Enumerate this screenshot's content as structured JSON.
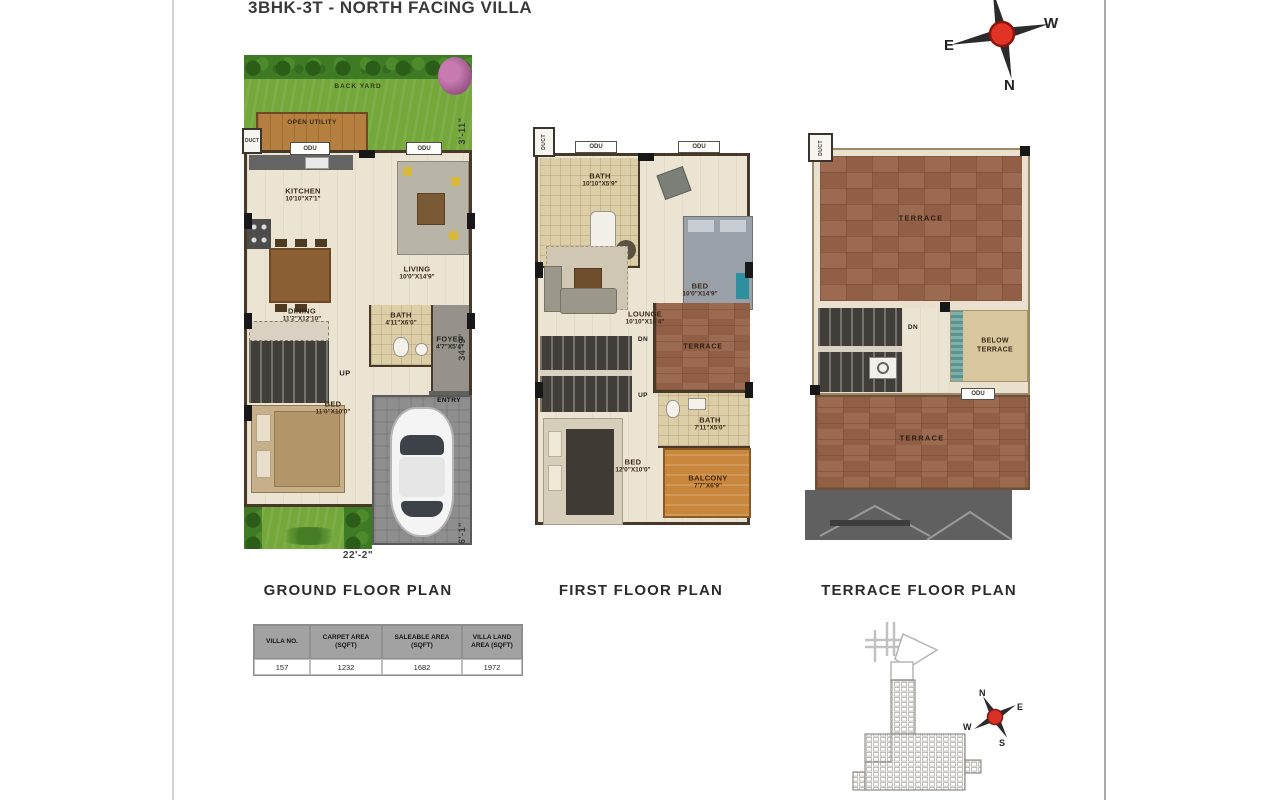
{
  "title": "3BHK-3T - NORTH FACING VILLA",
  "compass": {
    "e": "E",
    "w": "W",
    "n": "N"
  },
  "sitemap_compass": {
    "n": "N",
    "e": "E",
    "w": "W",
    "s": "S"
  },
  "ground": {
    "label": "GROUND FLOOR PLAN",
    "back_yard": "BACK YARD",
    "open_utility": "OPEN UTILITY",
    "duct": "DUCT",
    "odu1": "ODU",
    "odu2": "ODU",
    "kitchen": {
      "name": "KITCHEN",
      "dims": "10'10\"X7'1\""
    },
    "living": {
      "name": "LIVING",
      "dims": "10'0\"X14'9\""
    },
    "dining": {
      "name": "DINING",
      "dims": "11'2\"X12'10\""
    },
    "bath": {
      "name": "BATH",
      "dims": "4'11\"X6'0\""
    },
    "foyer": {
      "name": "FOYER",
      "dims": "4'7\"X5'4\""
    },
    "up": "UP",
    "bed": {
      "name": "BED",
      "dims": "11'0\"X10'0\""
    },
    "entry": "ENTRY",
    "parking": "PARKING",
    "dim_left_top": "3'-11\"",
    "dim_left_mid": "34'-9\"",
    "dim_left_bottom": "6'-1\"",
    "dim_bottom": "22'-2\""
  },
  "first": {
    "label": "FIRST FLOOR PLAN",
    "duct": "DUCT",
    "odu1": "ODU",
    "odu2": "ODU",
    "bath_top": {
      "name": "BATH",
      "dims": "10'10\"X5'9\""
    },
    "bed_top": {
      "name": "BED",
      "dims": "10'0\"X14'9\""
    },
    "lounge": {
      "name": "LOUNGE",
      "dims": "10'10\"X10'4\""
    },
    "dn": "DN",
    "up": "UP",
    "terrace": "TERRACE",
    "bath_bottom": {
      "name": "BATH",
      "dims": "7'11\"X5'0\""
    },
    "bed_bottom": {
      "name": "BED",
      "dims": "12'0\"X10'0\""
    },
    "balcony": {
      "name": "BALCONY",
      "dims": "7'7\"X6'9\""
    }
  },
  "terrace": {
    "label": "TERRACE FLOOR PLAN",
    "duct": "DUCT",
    "terrace_top": "TERRACE",
    "dn": "DN",
    "below_terrace": "BELOW TERRACE",
    "odu": "ODU",
    "terrace_bottom": "TERRACE"
  },
  "table": {
    "headers": [
      "VILLA NO.",
      "CARPET AREA (SQFT)",
      "SALEABLE AREA (SQFT)",
      "VILLA LAND AREA (SQFT)"
    ],
    "row": [
      "157",
      "1232",
      "1682",
      "1972"
    ]
  }
}
